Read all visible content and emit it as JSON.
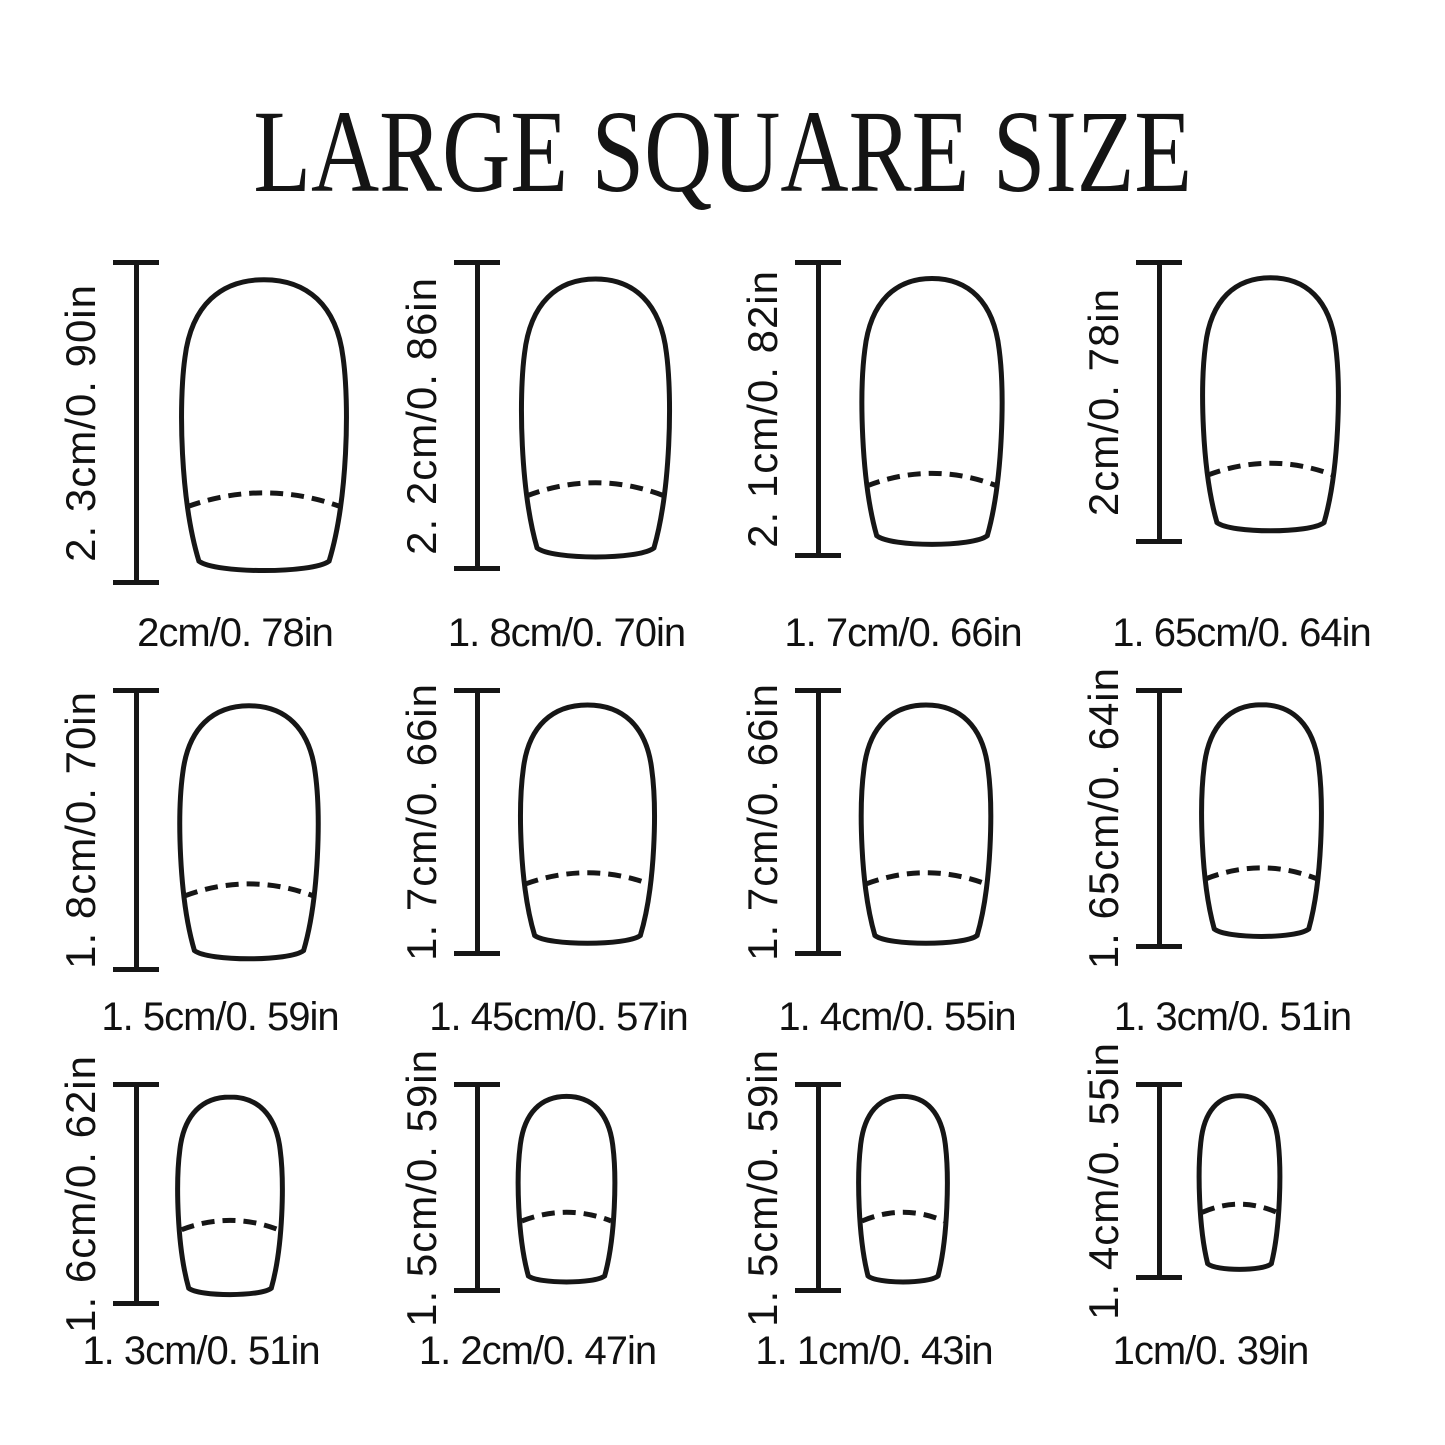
{
  "title": "LARGE SQUARE SIZE",
  "nails": [
    {
      "row": 0,
      "length_label": "2. 3cm/0. 90in",
      "width_label": "2cm/0. 78in",
      "length_cm": 2.3,
      "width_cm": 2.0
    },
    {
      "row": 0,
      "length_label": "2. 2cm/0. 86in",
      "width_label": "1. 8cm/0. 70in",
      "length_cm": 2.2,
      "width_cm": 1.8
    },
    {
      "row": 0,
      "length_label": "2. 1cm/0. 82in",
      "width_label": "1. 7cm/0. 66in",
      "length_cm": 2.1,
      "width_cm": 1.7
    },
    {
      "row": 0,
      "length_label": "2cm/0. 78in",
      "width_label": "1. 65cm/0. 64in",
      "length_cm": 2.0,
      "width_cm": 1.65
    },
    {
      "row": 1,
      "length_label": "1. 8cm/0. 70in",
      "width_label": "1. 5cm/0. 59in",
      "length_cm": 1.8,
      "width_cm": 1.5
    },
    {
      "row": 1,
      "length_label": "1. 7cm/0. 66in",
      "width_label": "1. 45cm/0. 57in",
      "length_cm": 1.7,
      "width_cm": 1.45
    },
    {
      "row": 1,
      "length_label": "1. 7cm/0. 66in",
      "width_label": "1. 4cm/0. 55in",
      "length_cm": 1.7,
      "width_cm": 1.4
    },
    {
      "row": 1,
      "length_label": "1. 65cm/0. 64in",
      "width_label": "1. 3cm/0. 51in",
      "length_cm": 1.65,
      "width_cm": 1.3
    },
    {
      "row": 2,
      "length_label": "1. 6cm/0. 62in",
      "width_label": "1. 3cm/0. 51in",
      "length_cm": 1.6,
      "width_cm": 1.3
    },
    {
      "row": 2,
      "length_label": "1. 5cm/0. 59in",
      "width_label": "1. 2cm/0. 47in",
      "length_cm": 1.5,
      "width_cm": 1.2
    },
    {
      "row": 2,
      "length_label": "1. 5cm/0. 59in",
      "width_label": "1. 1cm/0. 43in",
      "length_cm": 1.5,
      "width_cm": 1.1
    },
    {
      "row": 2,
      "length_label": "1. 4cm/0. 55in",
      "width_label": "1cm/0. 39in",
      "length_cm": 1.4,
      "width_cm": 1.0
    }
  ],
  "ink_color": "#161616"
}
